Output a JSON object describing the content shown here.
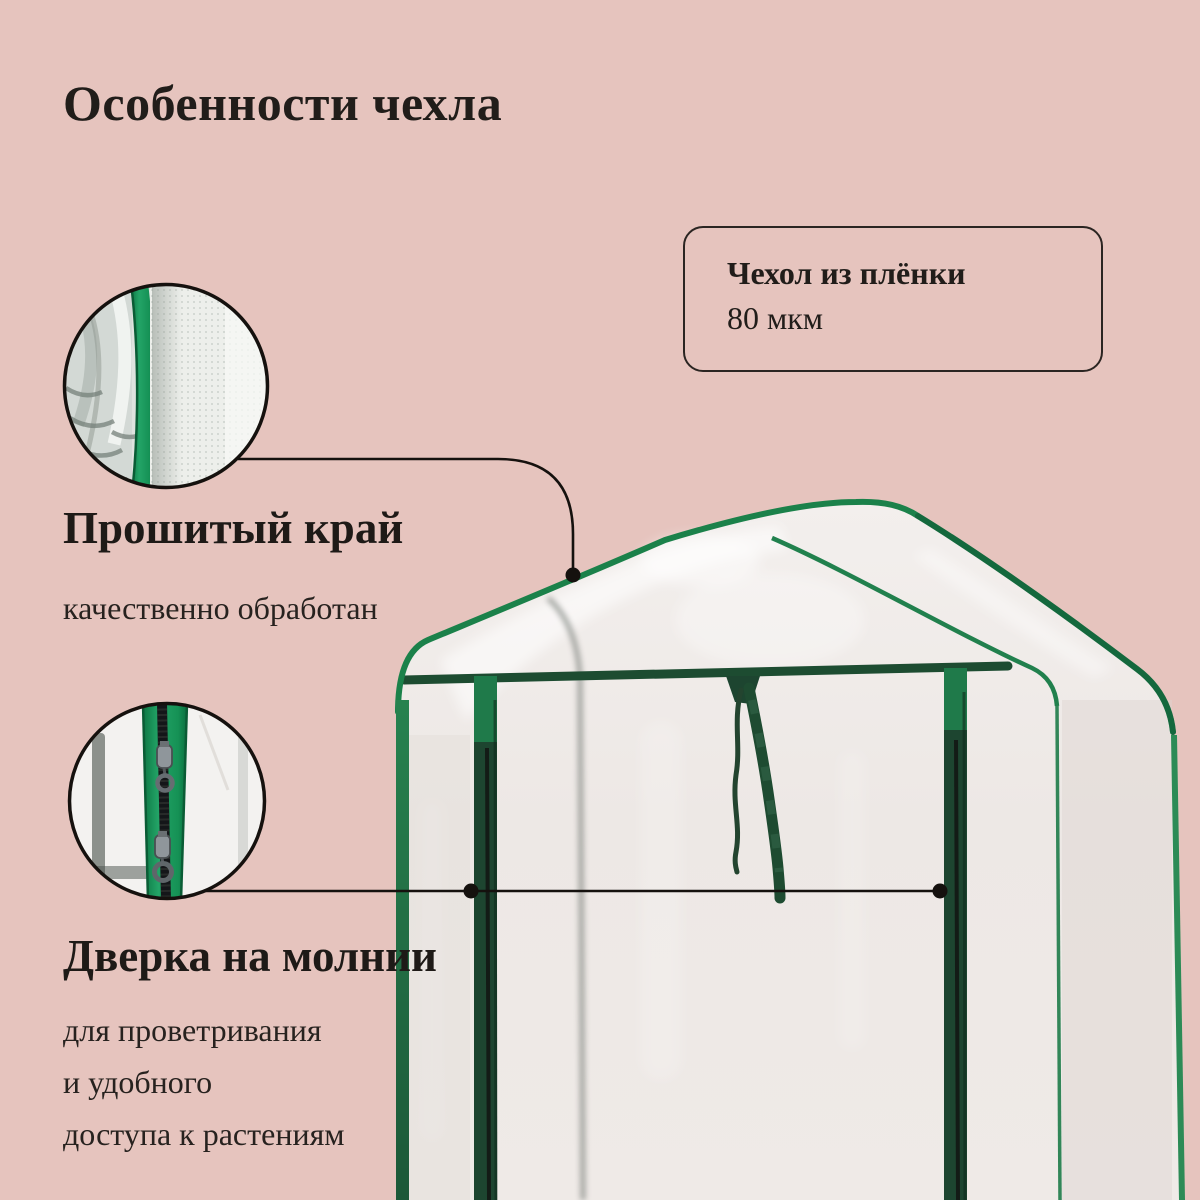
{
  "title": "Особенности чехла",
  "callout": {
    "line1": "Чехол из плёнки",
    "line2": "80 мкм"
  },
  "features": [
    {
      "heading": "Прошитый край",
      "lines": [
        "качественно обработан"
      ]
    },
    {
      "heading": "Дверка на молнии",
      "lines": [
        "для проветривания",
        "и удобного",
        "доступа к растениям"
      ]
    }
  ],
  "colors": {
    "background_pink": "#e6c4be",
    "film_white": "#eee9e6",
    "edge_trim_green": "#1b814a",
    "frame_dark_green": "#1d4530",
    "zipper_tape_green": "#1f9c5f",
    "leader_line_black": "#15110e",
    "text_black": "#211d1a"
  }
}
